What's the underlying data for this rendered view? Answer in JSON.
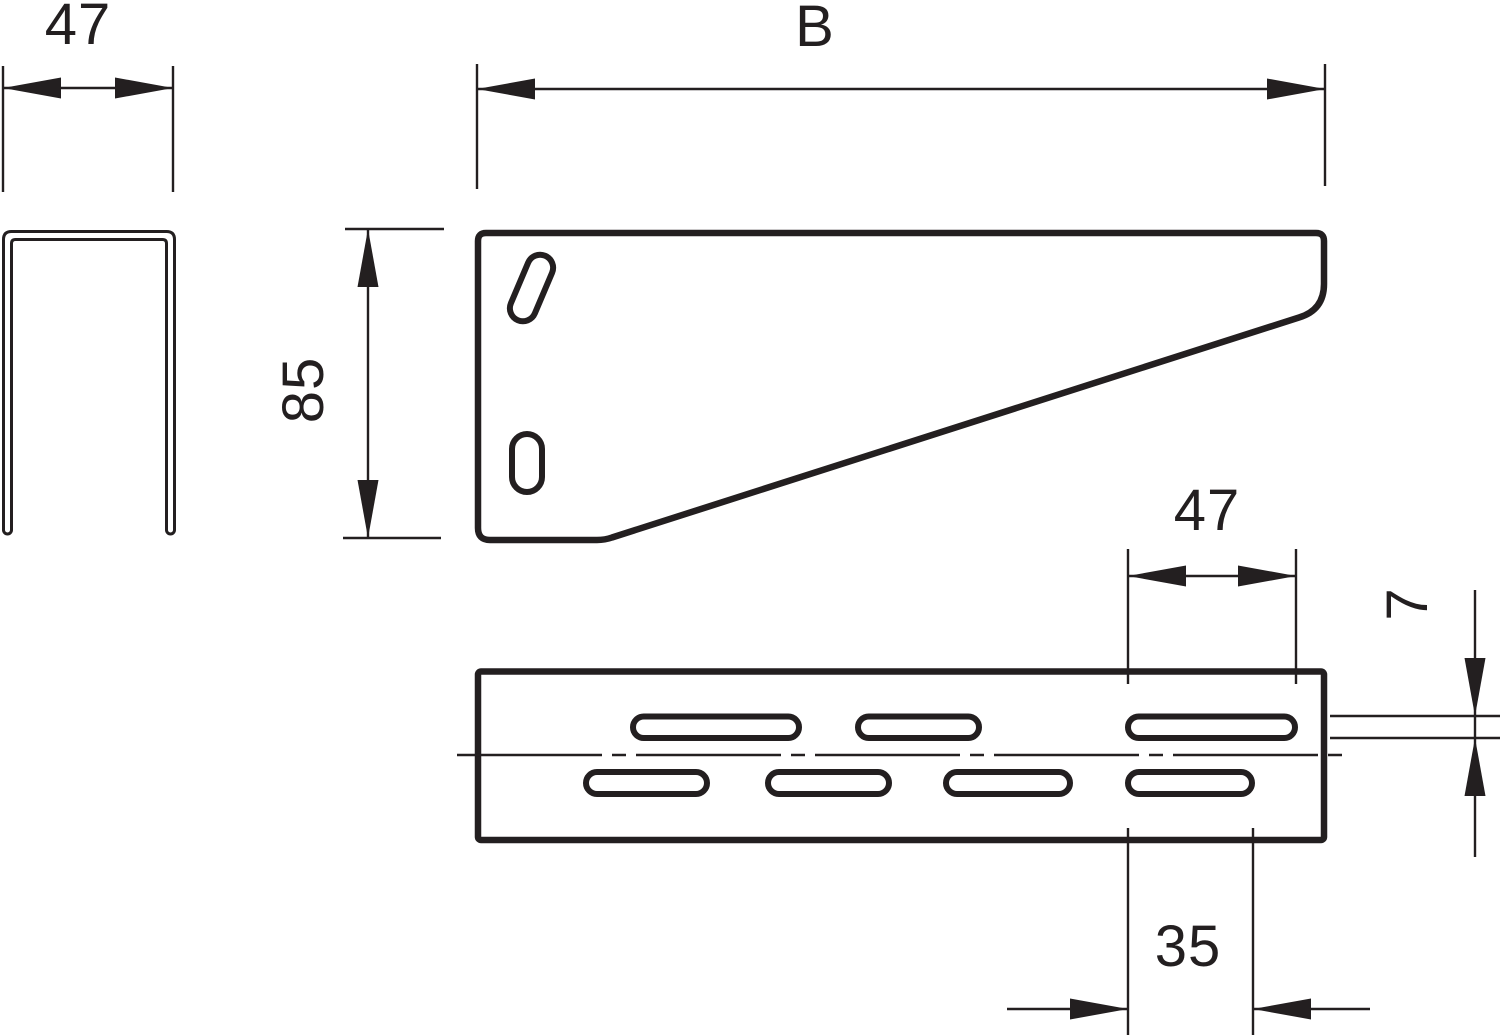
{
  "colors": {
    "line": "#231f20",
    "background": "#ffffff"
  },
  "views": {
    "profile": {
      "width_label": "47"
    },
    "side": {
      "length_label": "B",
      "height_label": "85"
    },
    "plan": {
      "slot_length_label": "47",
      "slot_height_label": "7",
      "slot_short_label": "35"
    }
  }
}
